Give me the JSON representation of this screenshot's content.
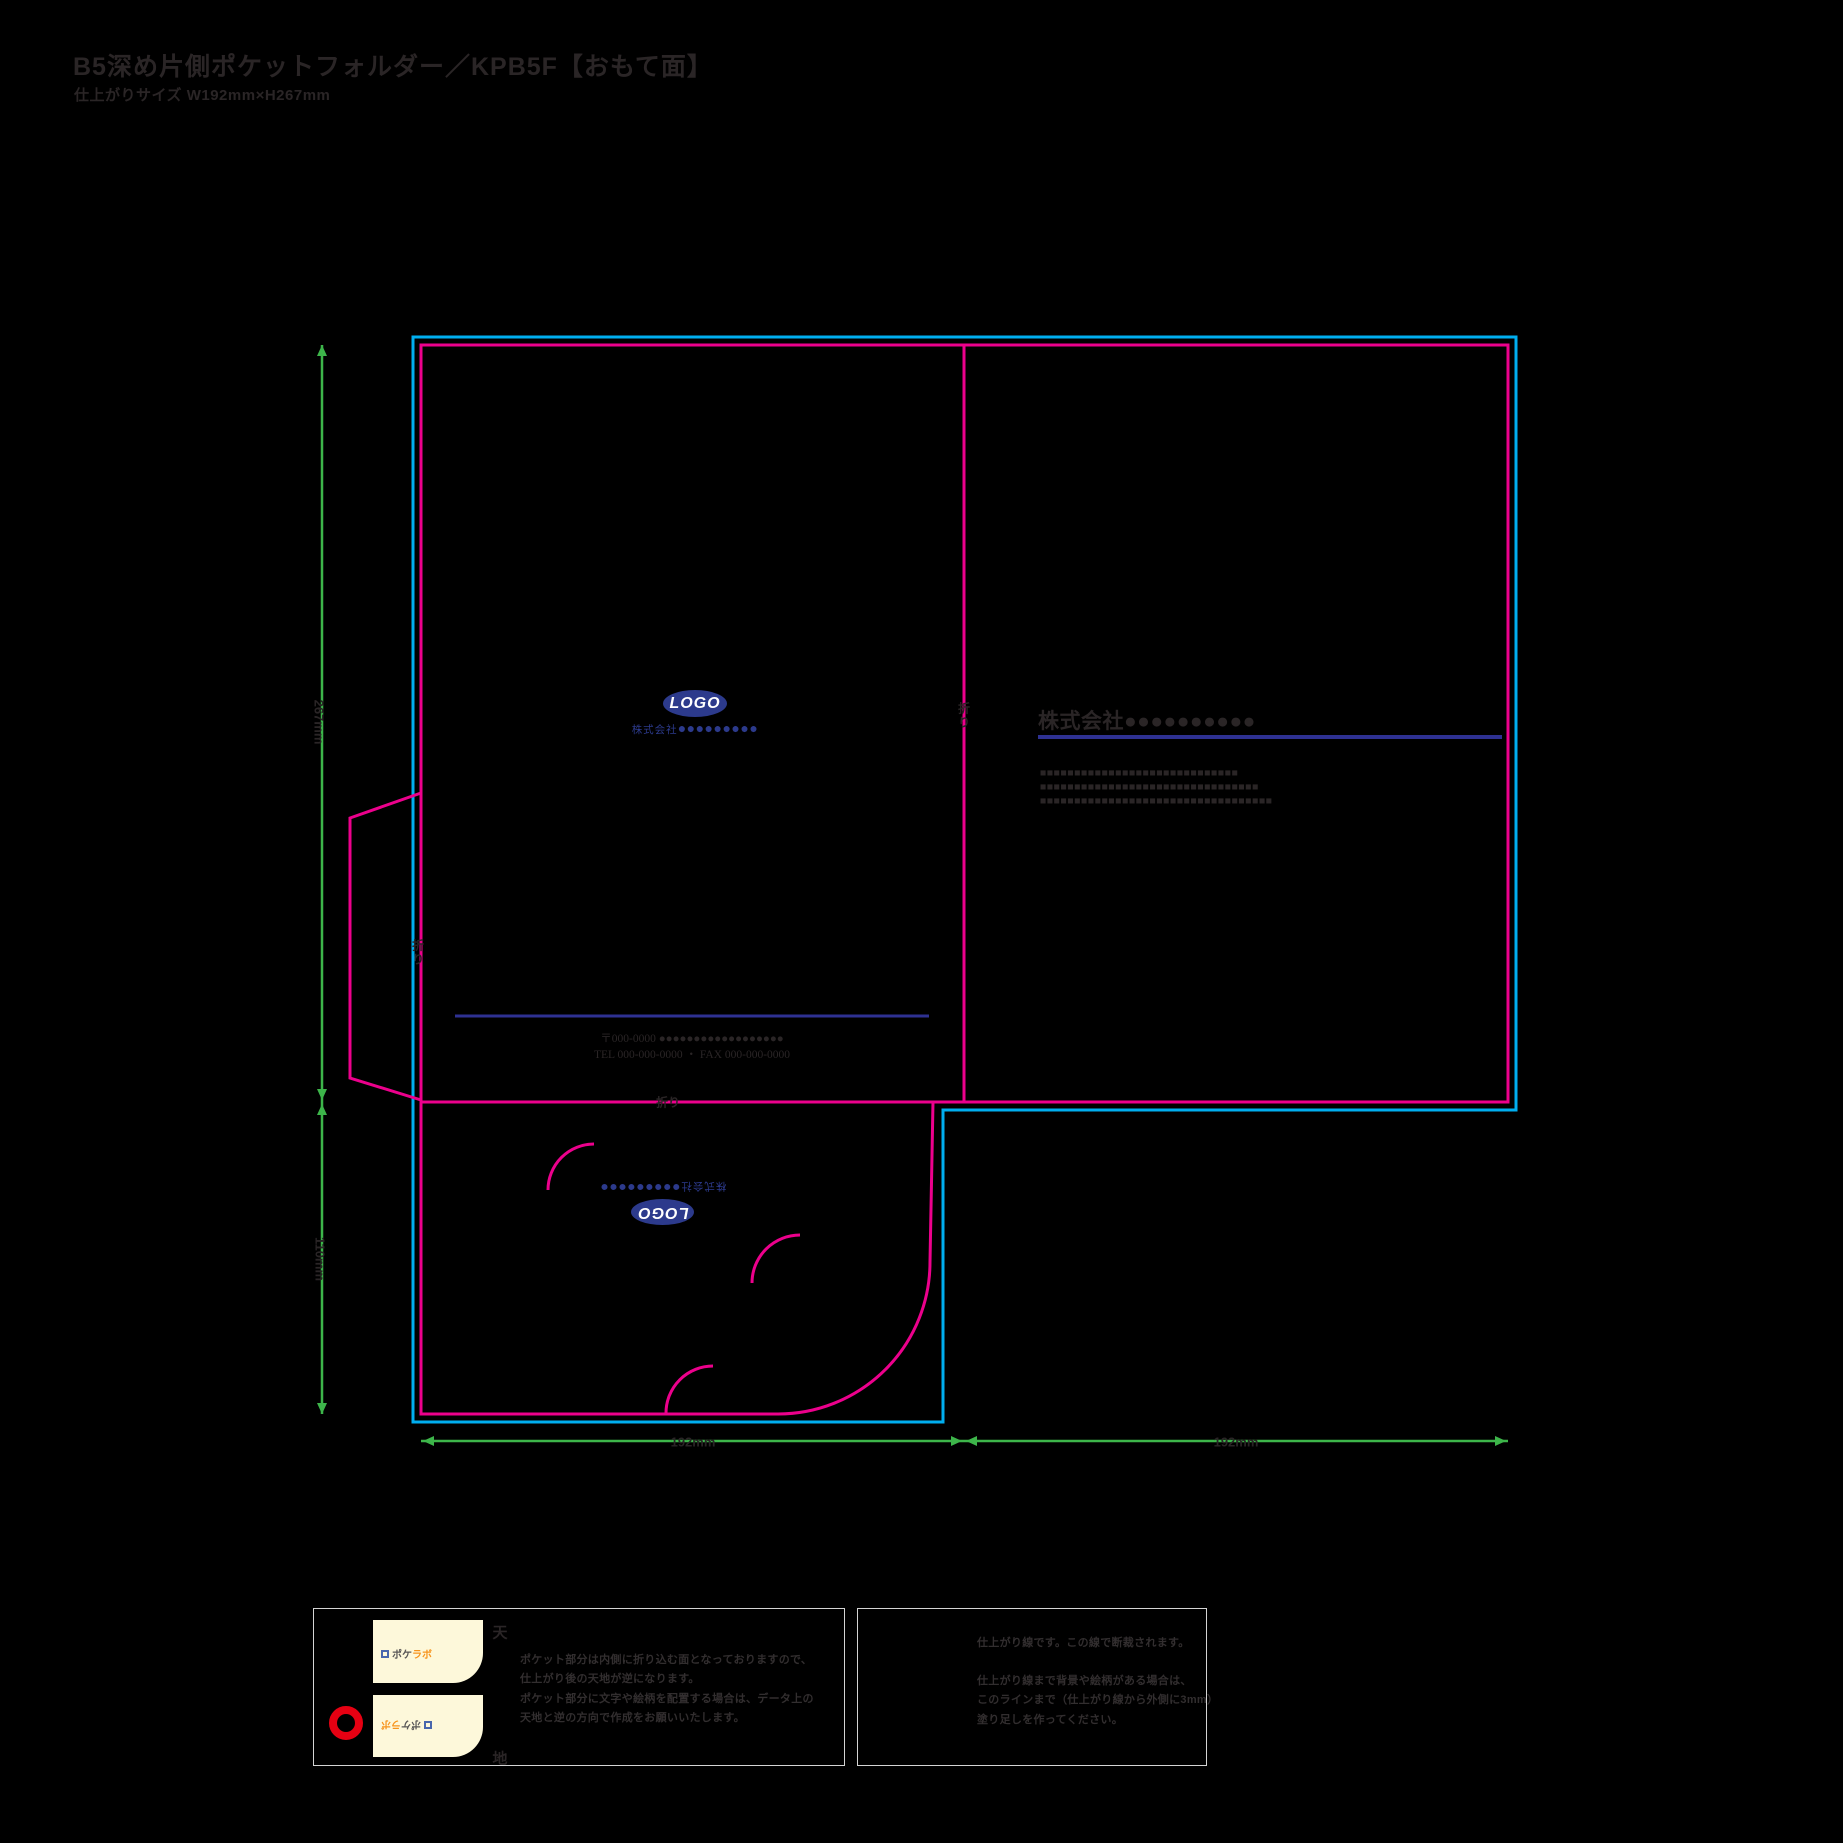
{
  "page": {
    "title": "B5深め片側ポケットフォルダー／KPB5F【おもて面】",
    "subtitle": "仕上がりサイズ W192mm×H267mm"
  },
  "colors": {
    "ink": "#2a2526",
    "cyan": "#00aeef",
    "magenta": "#ec008c",
    "green": "#3db54a",
    "navy": "#2e3192",
    "logo": "#2c3a8c",
    "cream": "#fdf8da",
    "orange": "#f7941d",
    "red": "#e60012",
    "yellow": "#fff7a0",
    "border": "#d4d4d4",
    "white": "#ffffff"
  },
  "diagram": {
    "dimensions": {
      "height_cover": "267mm",
      "height_pocket": "110mm",
      "width_left": "192mm",
      "width_right": "192mm"
    },
    "fold_labels": {
      "spine": "折り",
      "flap": "折り",
      "pocket": "折り"
    },
    "front_cover": {
      "logo_text": "LOGO",
      "company_prefix": "株式会社",
      "company_circles": "●●●●●●●●●",
      "address_line1": "〒000-0000 ●●●●●●●●●●●●●●●●●●",
      "address_line2": "TEL 000-000-0000 ・ FAX 000-000-0000"
    },
    "back_cover": {
      "company_name": "株式会社●●●●●●●●●●",
      "rows": [
        "■■■■■■■■■■■■■■■■■■■■■■■■■■■■■",
        "■■■■■■■■■■■■■■■■■■■■■■■■■■■■■■■■",
        "■■■■■■■■■■■■■■■■■■■■■■■■■■■■■■■■■■"
      ]
    },
    "pocket": {
      "logo_text": "LOGO",
      "company_prefix": "株式会社",
      "company_circles": "●●●●●●●●●"
    }
  },
  "legend_left": {
    "top_label": "天",
    "bottom_label": "地",
    "thumb_logo_gray": "ポケ",
    "thumb_logo_orange": "ラボ",
    "lines": [
      "ポケット部分は内側に折り込む面となっておりますので、",
      "仕上がり後の天地が逆になります。",
      "ポケット部分に文字や絵柄を配置する場合は、データ上の",
      "天地と逆の方向で作成をお願いいたします。"
    ]
  },
  "legend_right": {
    "line1": "仕上がり線です。この線で断裁されます。",
    "lines": [
      "仕上がり線まで背景や絵柄がある場合は、",
      "このラインまで（仕上がり線から外側に3mm）",
      "塗り足しを作ってください。"
    ]
  }
}
